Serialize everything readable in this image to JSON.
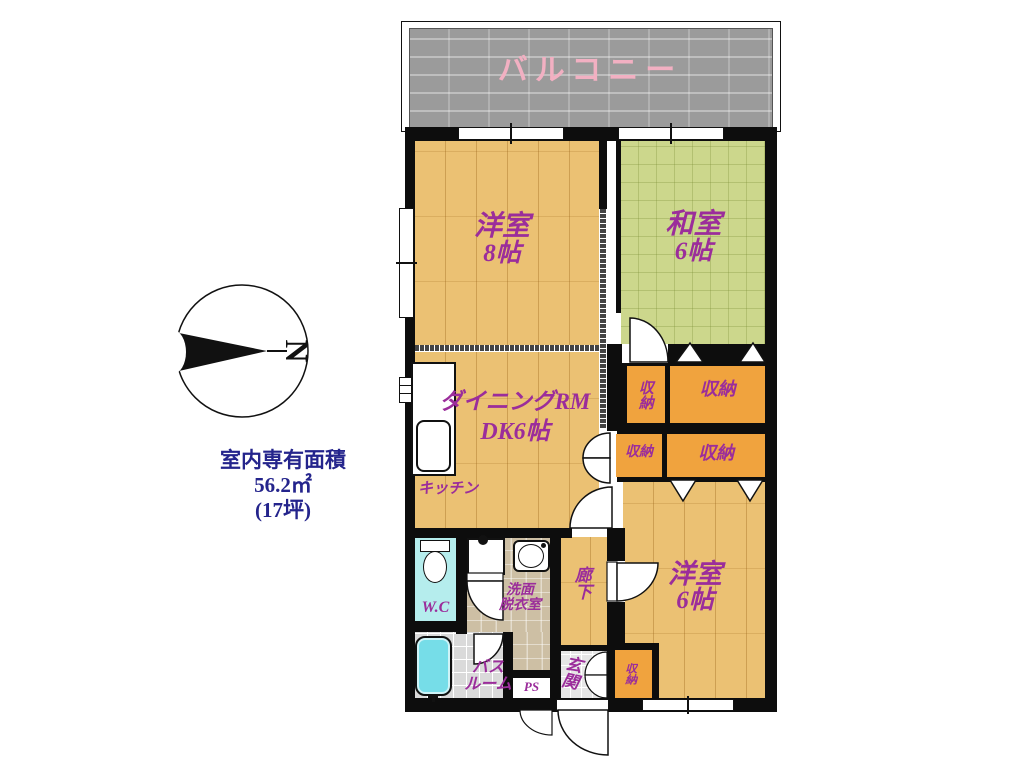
{
  "labels": {
    "balcony": "バルコニー",
    "room_w8_name": "洋室",
    "room_w8_size": "8帖",
    "room_j6_name": "和室",
    "room_j6_size": "6帖",
    "dining_l1": "ダイニングRM",
    "dining_l2": "DK6帖",
    "kitchen": "キッチン",
    "room_w6_name": "洋室",
    "room_w6_size": "6帖",
    "hallway": "廊下",
    "entrance": "玄関",
    "wc": "W.C",
    "washroom_l1": "洗面",
    "washroom_l2": "脱衣室",
    "bath_l1": "バス",
    "bath_l2": "ルーム",
    "ps": "PS",
    "compass_n": "N"
  },
  "storages": [
    "収納",
    "収納",
    "収納",
    "収納",
    "収納"
  ],
  "area": {
    "title": "室内専有面積",
    "size_sqm": "56.2㎡",
    "size_tsubo": "(17坪)"
  },
  "colors": {
    "wall": "#0d0d0d",
    "wood_floor": "#ebc173",
    "tatami": "#ccd78c",
    "storage_orange": "#f0a33e",
    "balcony_gray": "#9b9b9b",
    "label_purple": "#9b2d9b",
    "balcony_pink": "#f2b0c2",
    "area_navy": "#24248c",
    "wc_cyan": "#b5eded",
    "washroom_tan": "#cdbfa4",
    "bath_gray": "#dadada",
    "bathtub_cyan": "#76dde8"
  }
}
